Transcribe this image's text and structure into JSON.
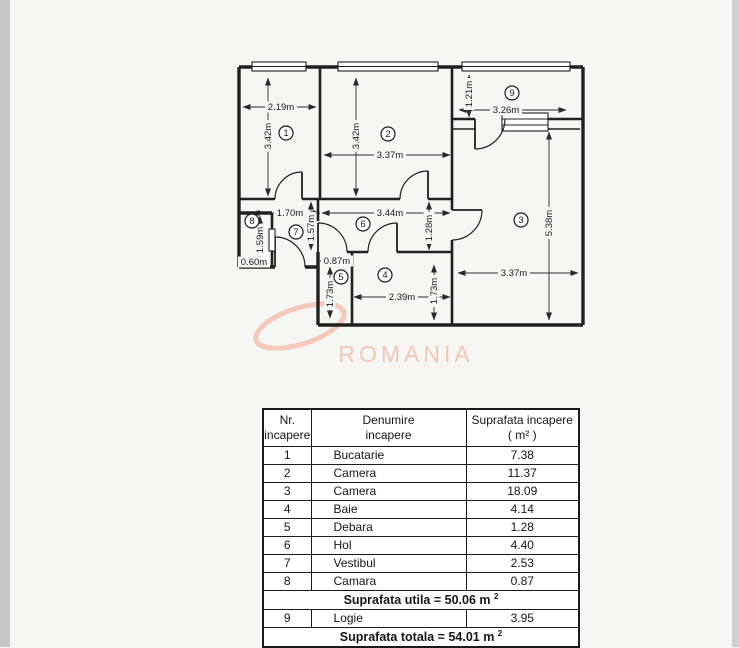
{
  "watermark": {
    "text": "ROMANIA",
    "color": "#f3c1ae"
  },
  "floor_plan": {
    "rooms": [
      {
        "n": "1",
        "x": 286,
        "y": 133
      },
      {
        "n": "2",
        "x": 388,
        "y": 134
      },
      {
        "n": "3",
        "x": 521,
        "y": 220
      },
      {
        "n": "4",
        "x": 385,
        "y": 275
      },
      {
        "n": "5",
        "x": 341,
        "y": 277
      },
      {
        "n": "6",
        "x": 363,
        "y": 224
      },
      {
        "n": "7",
        "x": 296,
        "y": 232
      },
      {
        "n": "8",
        "x": 252,
        "y": 221
      },
      {
        "n": "9",
        "x": 512,
        "y": 93
      }
    ],
    "dimensions": [
      {
        "label": "2.19m",
        "o": "h",
        "y": 107,
        "x1": 243,
        "x2": 316,
        "lx": 281
      },
      {
        "label": "3.42m",
        "o": "v",
        "x": 268,
        "y1": 78,
        "y2": 196,
        "ly": 136
      },
      {
        "label": "3.42m",
        "o": "v",
        "x": 356,
        "y1": 78,
        "y2": 196,
        "ly": 136
      },
      {
        "label": "3.37m",
        "o": "h",
        "y": 155,
        "x1": 324,
        "x2": 450,
        "lx": 390
      },
      {
        "label": "1.21m",
        "o": "v",
        "x": 469,
        "y1": 75,
        "y2": 117,
        "ly": 94
      },
      {
        "label": "3.26m",
        "o": "h",
        "y": 110,
        "x1": 459,
        "x2": 566,
        "lx": 506
      },
      {
        "label": "5.38m",
        "o": "v",
        "x": 549,
        "y1": 132,
        "y2": 320,
        "ly": 223
      },
      {
        "label": "3.37m",
        "o": "h",
        "y": 273,
        "x1": 458,
        "x2": 578,
        "lx": 514
      },
      {
        "label": "1.70m",
        "o": "h",
        "y": 213,
        "x1": 252,
        "x2": 320,
        "lx": 290
      },
      {
        "label": "3.44m",
        "o": "h",
        "y": 213,
        "x1": 322,
        "x2": 450,
        "lx": 390
      },
      {
        "label": "1.57m",
        "o": "v",
        "x": 311,
        "y1": 202,
        "y2": 250,
        "ly": 228
      },
      {
        "label": "1.28m",
        "o": "v",
        "x": 429,
        "y1": 202,
        "y2": 250,
        "ly": 228
      },
      {
        "label": "1.59m",
        "o": "v",
        "x": 260,
        "y1": 216,
        "y2": 264,
        "ly": 240
      },
      {
        "label": "0.60m",
        "o": "h",
        "y": 262,
        "x1": 240,
        "x2": 270,
        "lx": 254
      },
      {
        "label": "0.87m",
        "o": "h",
        "y": 261,
        "x1": 320,
        "x2": 350,
        "lx": 337
      },
      {
        "label": "1.73m",
        "o": "v",
        "x": 330,
        "y1": 267,
        "y2": 318,
        "ly": 294
      },
      {
        "label": "2.39m",
        "o": "h",
        "y": 297,
        "x1": 354,
        "x2": 450,
        "lx": 402
      },
      {
        "label": "1.73m",
        "o": "v",
        "x": 434,
        "y1": 265,
        "y2": 320,
        "ly": 291
      }
    ]
  },
  "table": {
    "header": {
      "col1_line1": "Nr.",
      "col1_line2": "incapere",
      "col2_line1": "Denumire",
      "col2_line2": "incapere",
      "col3_line1": "Suprafata incapere",
      "col3_line2": "( m² )"
    },
    "rows": [
      {
        "nr": "1",
        "name": "Bucatarie",
        "area": "7.38"
      },
      {
        "nr": "2",
        "name": "Camera",
        "area": "11.37"
      },
      {
        "nr": "3",
        "name": "Camera",
        "area": "18.09"
      },
      {
        "nr": "4",
        "name": "Baie",
        "area": "4.14"
      },
      {
        "nr": "5",
        "name": "Debara",
        "area": "1.28"
      },
      {
        "nr": "6",
        "name": "Hol",
        "area": "4.40"
      },
      {
        "nr": "7",
        "name": "Vestibul",
        "area": "2.53"
      },
      {
        "nr": "8",
        "name": "Camara",
        "area": "0.87"
      }
    ],
    "subtotal_text": "Suprafata utila = 50.06 m",
    "subtotal_sup": "2",
    "logie_row": {
      "nr": "9",
      "name": "Logie",
      "area": "3.95"
    },
    "total_text": "Suprafata totala = 54.01 m",
    "total_sup": "2"
  }
}
